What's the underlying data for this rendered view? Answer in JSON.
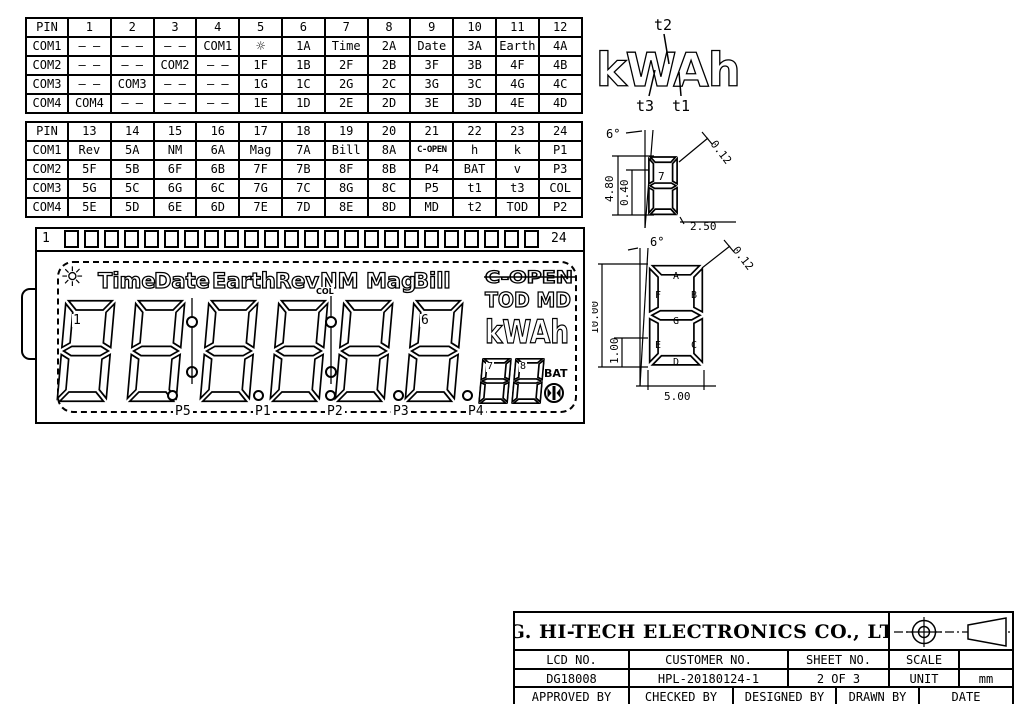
{
  "tables": {
    "table1": {
      "rows": [
        [
          "PIN",
          "1",
          "2",
          "3",
          "4",
          "5",
          "6",
          "7",
          "8",
          "9",
          "10",
          "11",
          "12"
        ],
        [
          "COM1",
          "– –",
          "– –",
          "– –",
          "COM1",
          "☼",
          "1A",
          "Time",
          "2A",
          "Date",
          "3A",
          "Earth",
          "4A"
        ],
        [
          "COM2",
          "– –",
          "– –",
          "COM2",
          "– –",
          "1F",
          "1B",
          "2F",
          "2B",
          "3F",
          "3B",
          "4F",
          "4B"
        ],
        [
          "COM3",
          "– –",
          "COM3",
          "– –",
          "– –",
          "1G",
          "1C",
          "2G",
          "2C",
          "3G",
          "3C",
          "4G",
          "4C"
        ],
        [
          "COM4",
          "COM4",
          "– –",
          "– –",
          "– –",
          "1E",
          "1D",
          "2E",
          "2D",
          "3E",
          "3D",
          "4E",
          "4D"
        ]
      ]
    },
    "table2": {
      "rows": [
        [
          "PIN",
          "13",
          "14",
          "15",
          "16",
          "17",
          "18",
          "19",
          "20",
          "21",
          "22",
          "23",
          "24"
        ],
        [
          "COM1",
          "Rev",
          "5A",
          "NM",
          "6A",
          "Mag",
          "7A",
          "Bill",
          "8A",
          "C-OPEN",
          "h",
          "k",
          "P1"
        ],
        [
          "COM2",
          "5F",
          "5B",
          "6F",
          "6B",
          "7F",
          "7B",
          "8F",
          "8B",
          "P4",
          "BAT",
          "v",
          "P3"
        ],
        [
          "COM3",
          "5G",
          "5C",
          "6G",
          "6C",
          "7G",
          "7C",
          "8G",
          "8C",
          "P5",
          "t1",
          "t3",
          "COL"
        ],
        [
          "COM4",
          "5E",
          "5D",
          "6E",
          "6D",
          "7E",
          "7D",
          "8E",
          "8D",
          "MD",
          "t2",
          "TOD",
          "P2"
        ]
      ]
    }
  },
  "kwah_diagram": {
    "word": "kWAh",
    "t1": "t1",
    "t2": "t2",
    "t3": "t3"
  },
  "dim_small": {
    "angle": "6°",
    "digit": "7",
    "dim_height": "4.80",
    "dim_inner": "0.40",
    "dim_gap": "0.12",
    "dim_width": "2.50"
  },
  "dim_large": {
    "angle": "6°",
    "dim_height": "10.00",
    "dim_inner": "1.00",
    "dim_gap": "0.12",
    "dim_width": "5.00",
    "seg_a": "A",
    "seg_b": "B",
    "seg_c": "C",
    "seg_d": "D",
    "seg_e": "E",
    "seg_f": "F",
    "seg_g": "G"
  },
  "lcd": {
    "pin_first": "1",
    "pin_last": "24",
    "pin_count": 24,
    "sun": "☼",
    "annunciators": [
      "Time",
      "Date",
      "Earth",
      "Rev",
      "NM",
      "Mag",
      "Bill"
    ],
    "c_open": "C-OPEN",
    "tod_md": "TOD MD",
    "kwah": "kWAh",
    "col": "COL",
    "bat": "BAT",
    "digit1_label": "1",
    "digit6_label": "6",
    "digit7_label": "7",
    "digit8_label": "8",
    "p_labels": [
      "P5",
      "P1",
      "P2",
      "P3",
      "P4"
    ]
  },
  "title_block": {
    "company": "D.G. HI-TECH ELECTRONICS CO., LTD.",
    "lcd_no_label": "LCD NO.",
    "customer_no_label": "CUSTOMER NO.",
    "sheet_no_label": "SHEET NO.",
    "scale_label": "SCALE",
    "lcd_no": "DG18008",
    "customer_no": "HPL-20180124-1",
    "sheet_no": "2 OF 3",
    "unit_label": "UNIT",
    "unit": "mm",
    "approved": "APPROVED BY",
    "checked": "CHECKED BY",
    "designed": "DESIGNED BY",
    "drawn": "DRAWN BY",
    "date": "DATE"
  }
}
